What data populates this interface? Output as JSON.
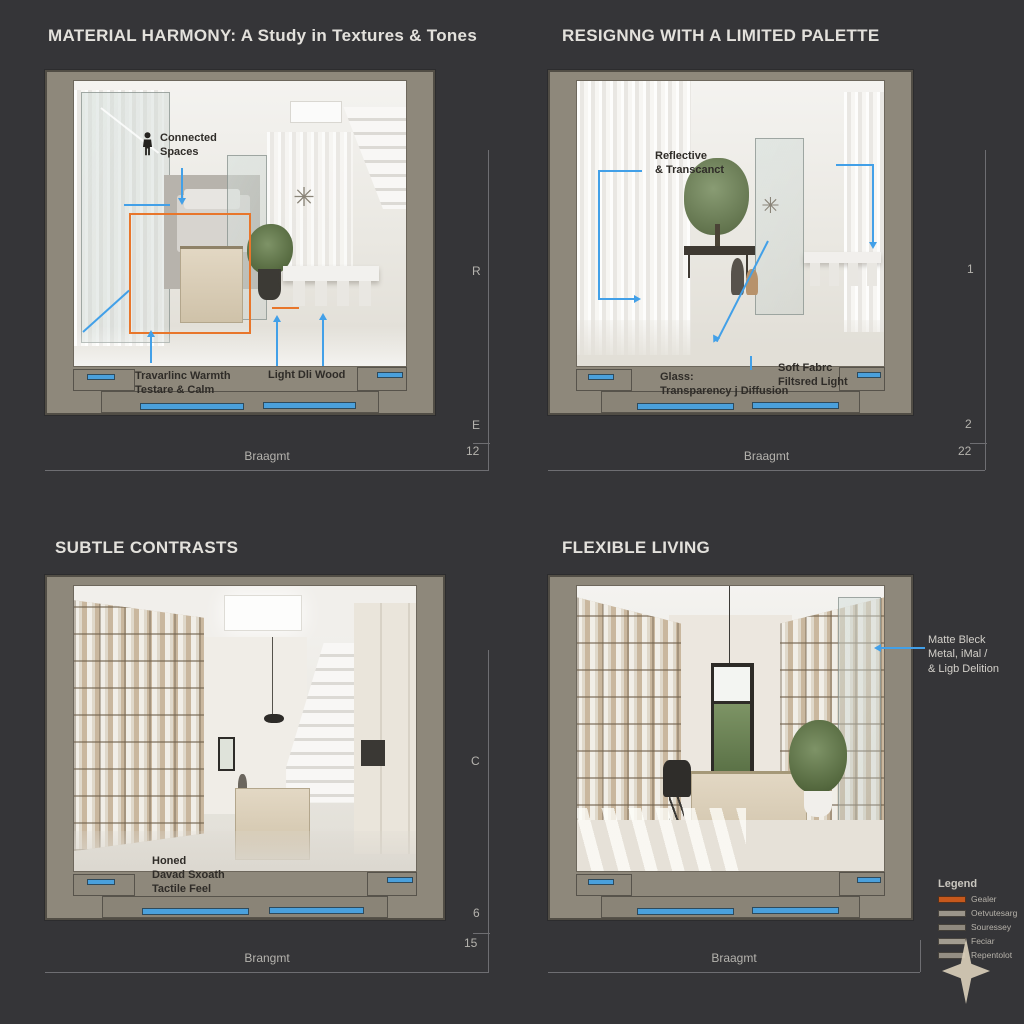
{
  "colors": {
    "background": "#353538",
    "annotation_blue": "#42a0e8",
    "annotation_orange": "#e8762b",
    "frame_taupe": "#8e887b",
    "glazing_blue": "#4aa0dc"
  },
  "icons": {
    "chandelier_glyph": "✳"
  },
  "panels": {
    "p1": {
      "title": "MATERIAL HARMONY: A Study in Textures & Tones",
      "callout_connected": "Connected\nSpaces",
      "callout_travertine": "Travarlinc Warmth\nTestare & Calm",
      "callout_wood": "Light Dli Wood",
      "dim_side_top": "R",
      "dim_side_bottom": "E",
      "dim_side_value": "12",
      "dim_bottom_label": "Braagmt"
    },
    "p2": {
      "title": "RESIGNNG WITH A LIMITED PALETTE",
      "callout_reflective": "Reflective\n& Transcanct",
      "callout_glass": "Glass:\nTransparency j Diffusion",
      "callout_fabric": "Soft Fabrc\nFiltsred Light",
      "dim_side_top": "1",
      "dim_side_bottom": "2",
      "dim_side_value": "22",
      "dim_bottom_label": "Braagmt"
    },
    "p3": {
      "title": "SUBTLE CONTRASTS",
      "callout_honed": "Honed\nDavad Sxoath\nTactile Feel",
      "dim_side_top": "C",
      "dim_side_bottom": "6",
      "dim_side_value": "15",
      "dim_bottom_label": "Brangmt"
    },
    "p4": {
      "title": "FLEXIBLE LIVING",
      "callout_matte": "Matte Bleck\nMetal, iMal /\n& Ligb Delition",
      "dim_bottom_label": "Braagmt"
    }
  },
  "legend": {
    "title": "Legend",
    "items": [
      {
        "label": "Gealer",
        "color": "#c6581c"
      },
      {
        "label": "Oetvutesarg",
        "color": "#9b958a"
      },
      {
        "label": "Souressey",
        "color": "#8f897e"
      },
      {
        "label": "Feciar",
        "color": "#a29c90"
      },
      {
        "label": "Repentolot",
        "color": "#948e83"
      }
    ]
  }
}
